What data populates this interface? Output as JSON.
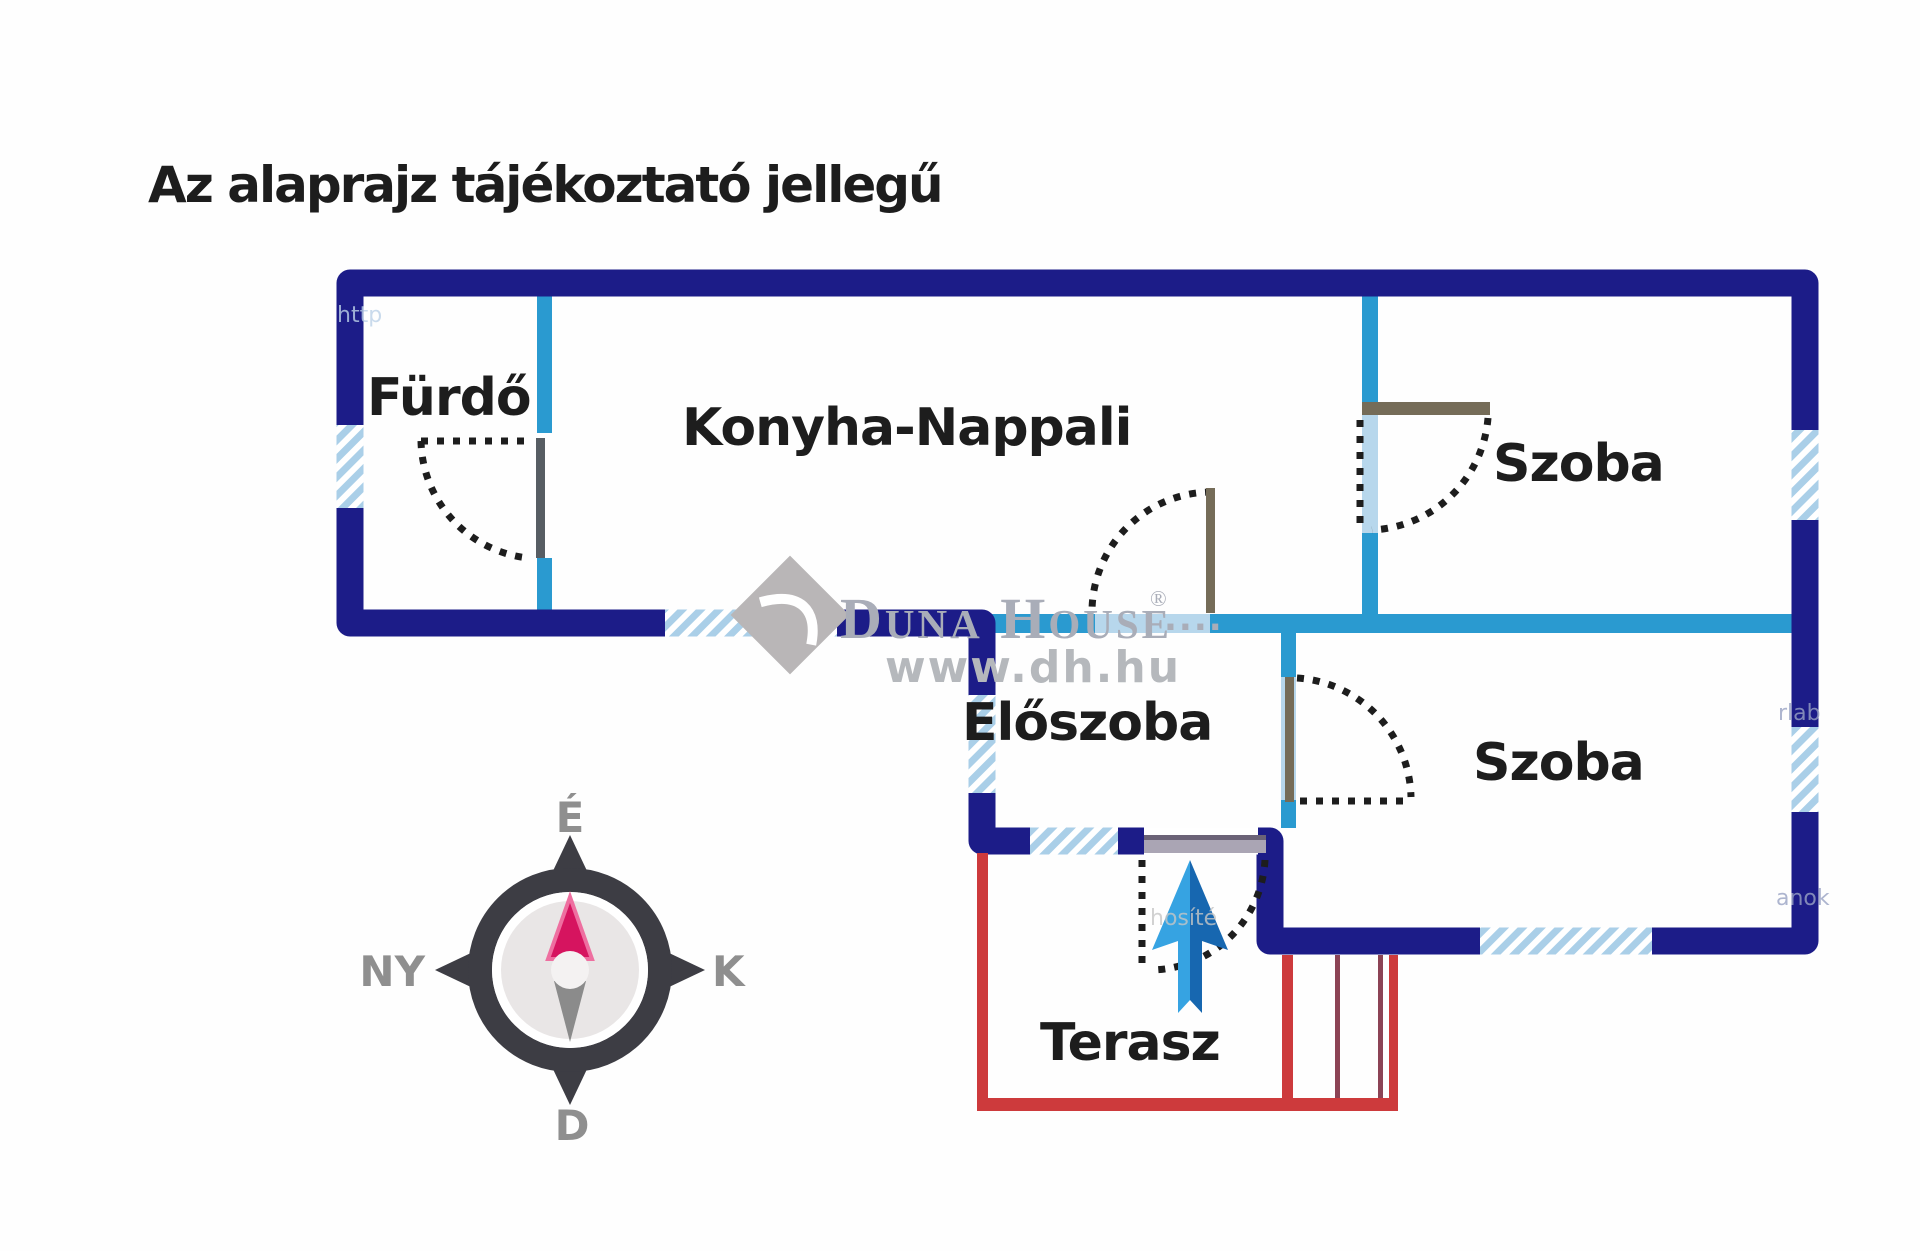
{
  "title": "Az alaprajz tájékoztató jellegű",
  "rooms": {
    "furdo": "Fürdő",
    "konyha_nappali": "Konyha-Nappali",
    "szoba_top": "Szoba",
    "eloszoba": "Előszoba",
    "szoba_bottom": "Szoba",
    "terasz": "Terasz"
  },
  "compass": {
    "north": "É",
    "west": "NY",
    "east": "K",
    "south": "D"
  },
  "watermark": {
    "brand": "Duna House",
    "registered": "®",
    "dots": "....",
    "url": "www.dh.hu"
  },
  "fragments": {
    "f1": "http",
    "f2": "hosíté",
    "f3": "rlab",
    "f4": "anok"
  },
  "colors": {
    "navy": "#1c1c88",
    "cyan": "#2a9ad0",
    "pale": "#b7d7ec",
    "win": "#aacfe8",
    "red": "#cd3a3c",
    "maroon": "#8c4355",
    "ink": "#1d1d1d",
    "label_gray": "#8f8f8f",
    "ring": "#3d3d44",
    "face": "#e9e6e6",
    "needle": "#d6145f",
    "needle_glow": "#ee6fa0",
    "tail": "#8b8b8b",
    "wm": "#a9adb8",
    "wm2": "#b5b8bc",
    "wm_diamond": "#b9b6b7",
    "arrow_light": "#36a3e2",
    "arrow_dark": "#1767b0",
    "leaf_gray": "#575d63",
    "leaf_tan": "#756c58",
    "bar": "#aaa5b4",
    "bar_edge": "#6b6377",
    "frag_blue": "#bcd2e8",
    "frag_gray": "#c6c6c6",
    "frag_navy": "#9aa3c4"
  }
}
